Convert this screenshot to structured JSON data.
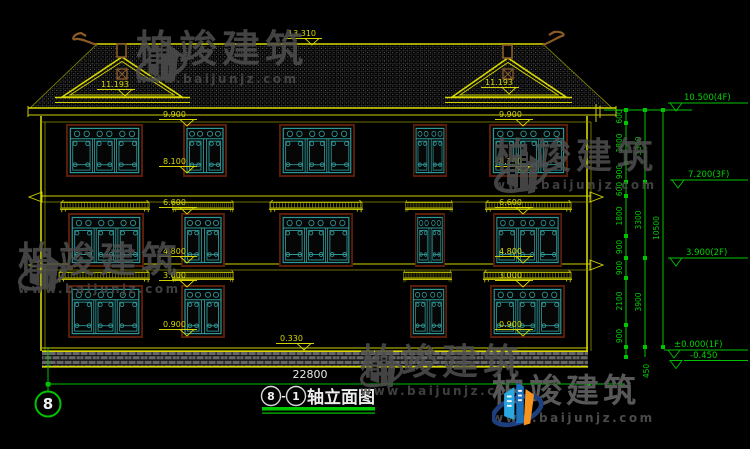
{
  "watermark": {
    "brand": "柏竣建筑",
    "url": "www.baijunjz.com"
  },
  "elevation_marks": {
    "ridge": "13.310",
    "gable": "11.193",
    "eave": "9.900",
    "win_top_3f": "8.100",
    "band_3f": "6.600",
    "sill_2f": "4.800",
    "awning_1f": "3.000",
    "sill_1f": "0.900",
    "plinth": "0.330"
  },
  "dims": {
    "right_segments": [
      "600",
      "1800",
      "900",
      "600",
      "1800",
      "900",
      "900",
      "2100",
      "900",
      "450"
    ],
    "right_subtotals": [
      "3300",
      "3300",
      "3900"
    ],
    "right_total": "10500",
    "levels": {
      "f4": "10.500(4F)",
      "f3": "7.200(3F)",
      "f2": "3.900(2F)",
      "f1": "±0.000(1F)",
      "ground": "-0.450"
    },
    "total_width": "22800"
  },
  "footer": {
    "axis_bubble": "8",
    "title_bubble_start": "8",
    "title_separator": "-",
    "title_bubble_end": "1",
    "title_text": "轴立面图"
  }
}
